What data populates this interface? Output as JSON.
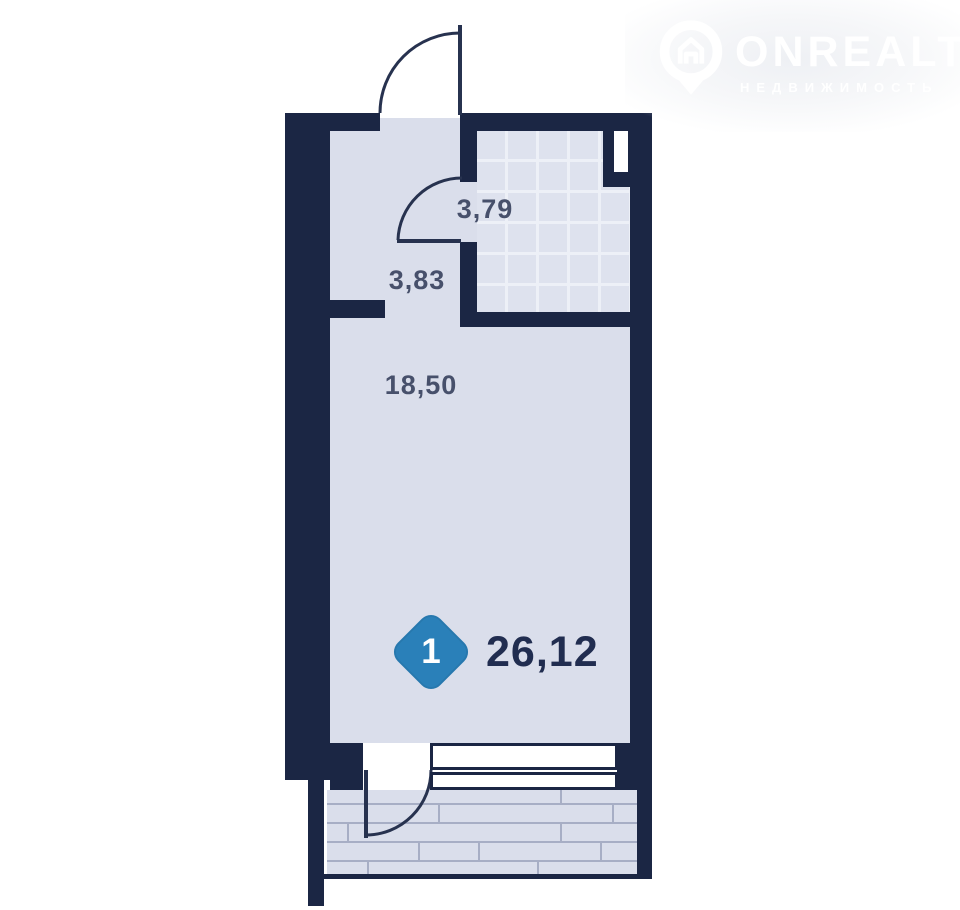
{
  "watermark": {
    "brand": "ONREALT",
    "tagline": "НЕДВИЖИМОСТЬ",
    "icon": "location-pin-house-icon"
  },
  "plan": {
    "unit_badge": {
      "number": "1",
      "shape": "diamond"
    },
    "total_area": "26,12",
    "rooms": [
      {
        "name": "bathroom",
        "area": "3,79"
      },
      {
        "name": "hallway",
        "area": "3,83"
      },
      {
        "name": "living-room",
        "area": "18,50"
      }
    ]
  },
  "colors": {
    "wall": "#1b2644",
    "floor": "#dadeeb",
    "tile-fill": "#dee2ee",
    "tile-line": "#edf0f7",
    "plank-line": "#a7aec5",
    "badge": "#2a80b9",
    "area-label": "#47506b",
    "total-label": "#212d50",
    "door-line": "#27324f"
  }
}
